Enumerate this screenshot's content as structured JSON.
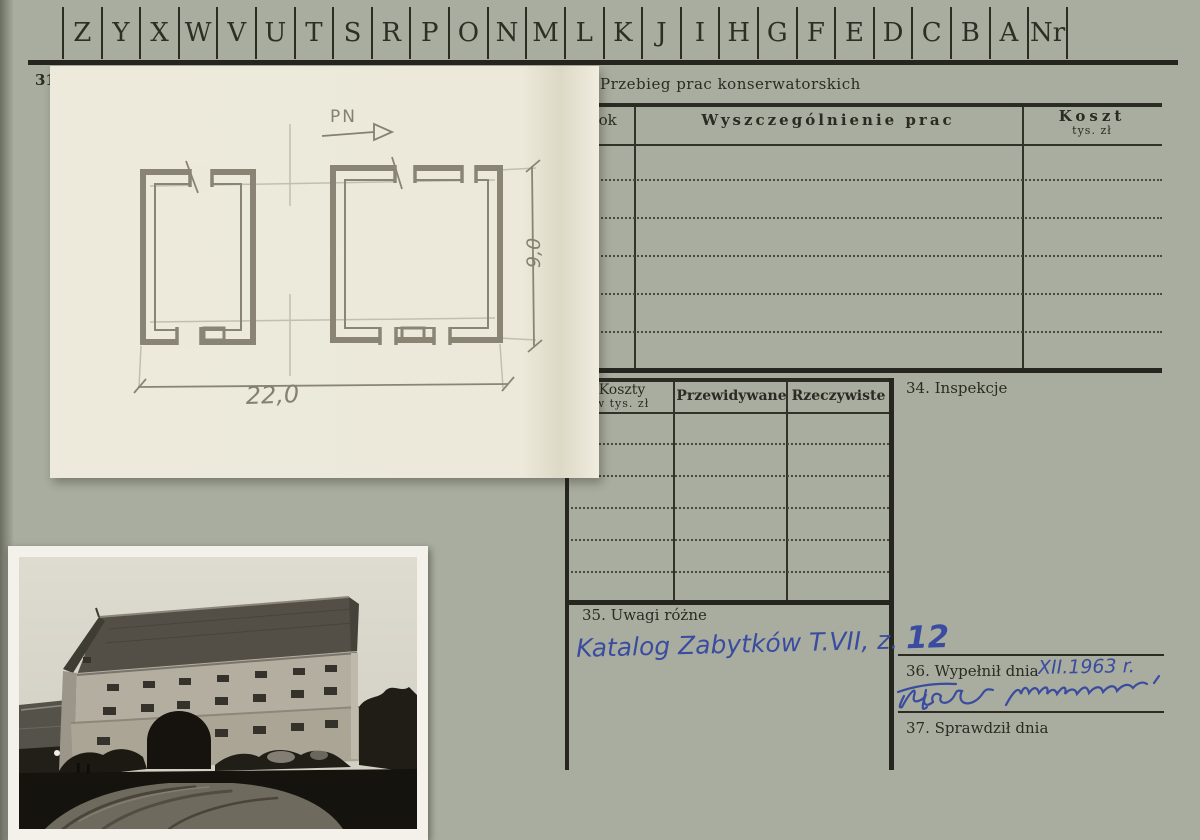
{
  "colors": {
    "paper": "#a9ad9f",
    "print_ink": "#2b2a23",
    "handwriting_blue": "#3a4c9f",
    "plan_sheet": "#ece9da",
    "pencil": "#8a8474"
  },
  "tabs": {
    "letters": [
      "Z",
      "Y",
      "X",
      "W",
      "V",
      "U",
      "T",
      "S",
      "R",
      "P",
      "O",
      "N",
      "M",
      "L",
      "K",
      "J",
      "I",
      "H",
      "G",
      "F",
      "E",
      "D",
      "C",
      "B",
      "A",
      "Nr"
    ]
  },
  "card": {
    "number": "31"
  },
  "conservation": {
    "title": "Przebieg prac konserwatorskich",
    "col_year": "Rok",
    "col_works": "Wyszczególnienie prac",
    "col_cost": "Koszt",
    "col_cost_sub": "tys. zł"
  },
  "costs": {
    "col1": "Koszty",
    "col1_sub": "w tys. zł",
    "col2": "Przewidywane",
    "col3": "Rzeczywiste"
  },
  "sections": {
    "inspections": "34. Inspekcje",
    "remarks": "35. Uwagi różne",
    "remarks_note": "Katalog Zabytków T.VII, z. ",
    "remarks_note_number": "12",
    "filled": "36. Wypełnił dnia",
    "filled_date": "XII.1963 r.",
    "checked": "37. Sprawdził dnia"
  },
  "drawing": {
    "north": "PN",
    "width_dim": "22,0",
    "height_dim": "9,0"
  },
  "photo": {
    "alt": "black-and-white photograph of a granary with arched gateway"
  }
}
